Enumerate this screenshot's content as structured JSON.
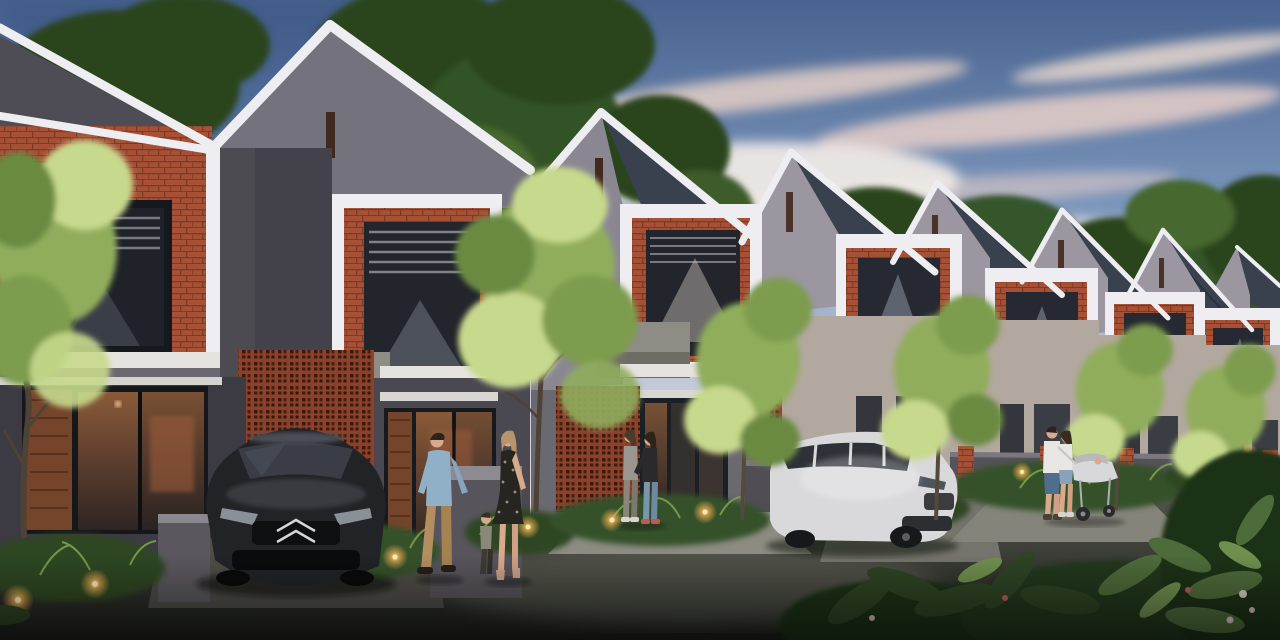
{
  "scene": {
    "description": "dusk architectural rendering of a receding row of gabled two-story townhouses",
    "houses_visible": 8,
    "vehicles": [
      "dark-sedan-citroen",
      "white-suv"
    ],
    "people_groups": [
      "walking-family-with-child",
      "two-women-at-entrance",
      "family-with-stroller"
    ],
    "garden_lights": 14
  },
  "palette": {
    "sky_top": "#46628e",
    "sky_mid": "#89a1c2",
    "sky_low": "#e9dcd6",
    "cloud_pink": "#ecd4c8",
    "cloud_white": "#f4ede7",
    "tree_dark": "#2a451f",
    "tree_mid": "#47682f",
    "foliage_sun": "#c7d98c",
    "foliage_mid": "#90ad5c",
    "trim_white": "#eeedf1",
    "gable_shaded": "#74727c",
    "gable_lit": "#9b96a0",
    "gable_dark": "#4e4d55",
    "shingle": "#39404e",
    "wall_dark": "#434149",
    "wall_gray": "#6b6970",
    "wall_beige": "#b2a89f",
    "brick": "#a65036",
    "brick_dark": "#7c3a27",
    "breeze_block": "#8f4029",
    "window_dark": "#22252b",
    "blind_light": "#ccd1d7",
    "glass_warm": "#b97a43",
    "concrete": "#8f8c85",
    "fence_gray": "#55535a",
    "road_light": "#74766a",
    "road_dark": "#22241e",
    "path_light": "#8d8c82",
    "car_body": "#212326",
    "chrome": "#d3d6db",
    "suv_body": "#d9d9db",
    "light_glow": "#ffb854",
    "light_core": "#ffeab2",
    "skin": "#d9a98c",
    "denim_shirt": "#8fb0c6",
    "khaki": "#b28e60",
    "dress_dark": "#26251f",
    "white_cloth": "#e9e7e3",
    "jeans": "#7b95ab",
    "trunk_brown": "#4e4236",
    "wood_door": "#74452a"
  }
}
